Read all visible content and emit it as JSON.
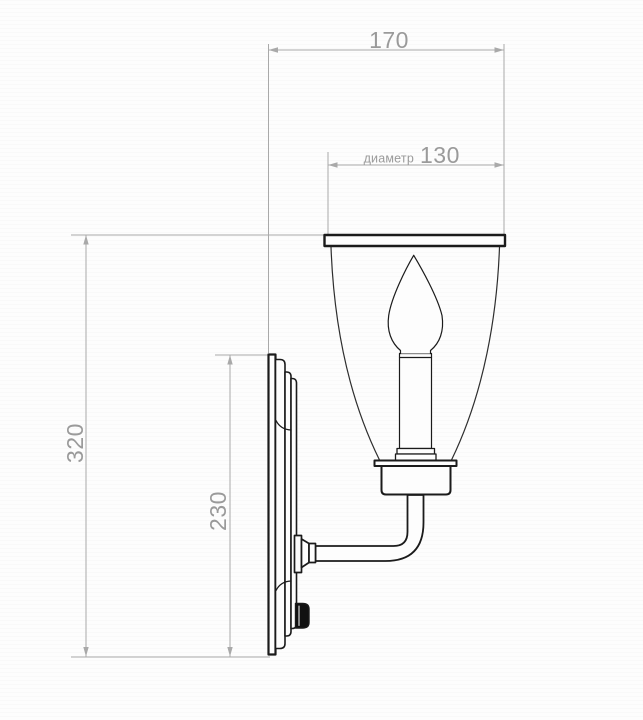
{
  "drawing": {
    "background_color": "#fdfdfd",
    "ink_color": "#1b1b1b",
    "glass_line_color": "#2e2e2e",
    "dimension_line_color": "#a9a9a9",
    "dimension_text_color": "#9a9a9a",
    "switch_color": "#111111",
    "dimensions": {
      "total_depth": "170",
      "diameter_label": "диаметр",
      "diameter_value": "130",
      "total_height": "320",
      "backplate_height": "230"
    }
  }
}
